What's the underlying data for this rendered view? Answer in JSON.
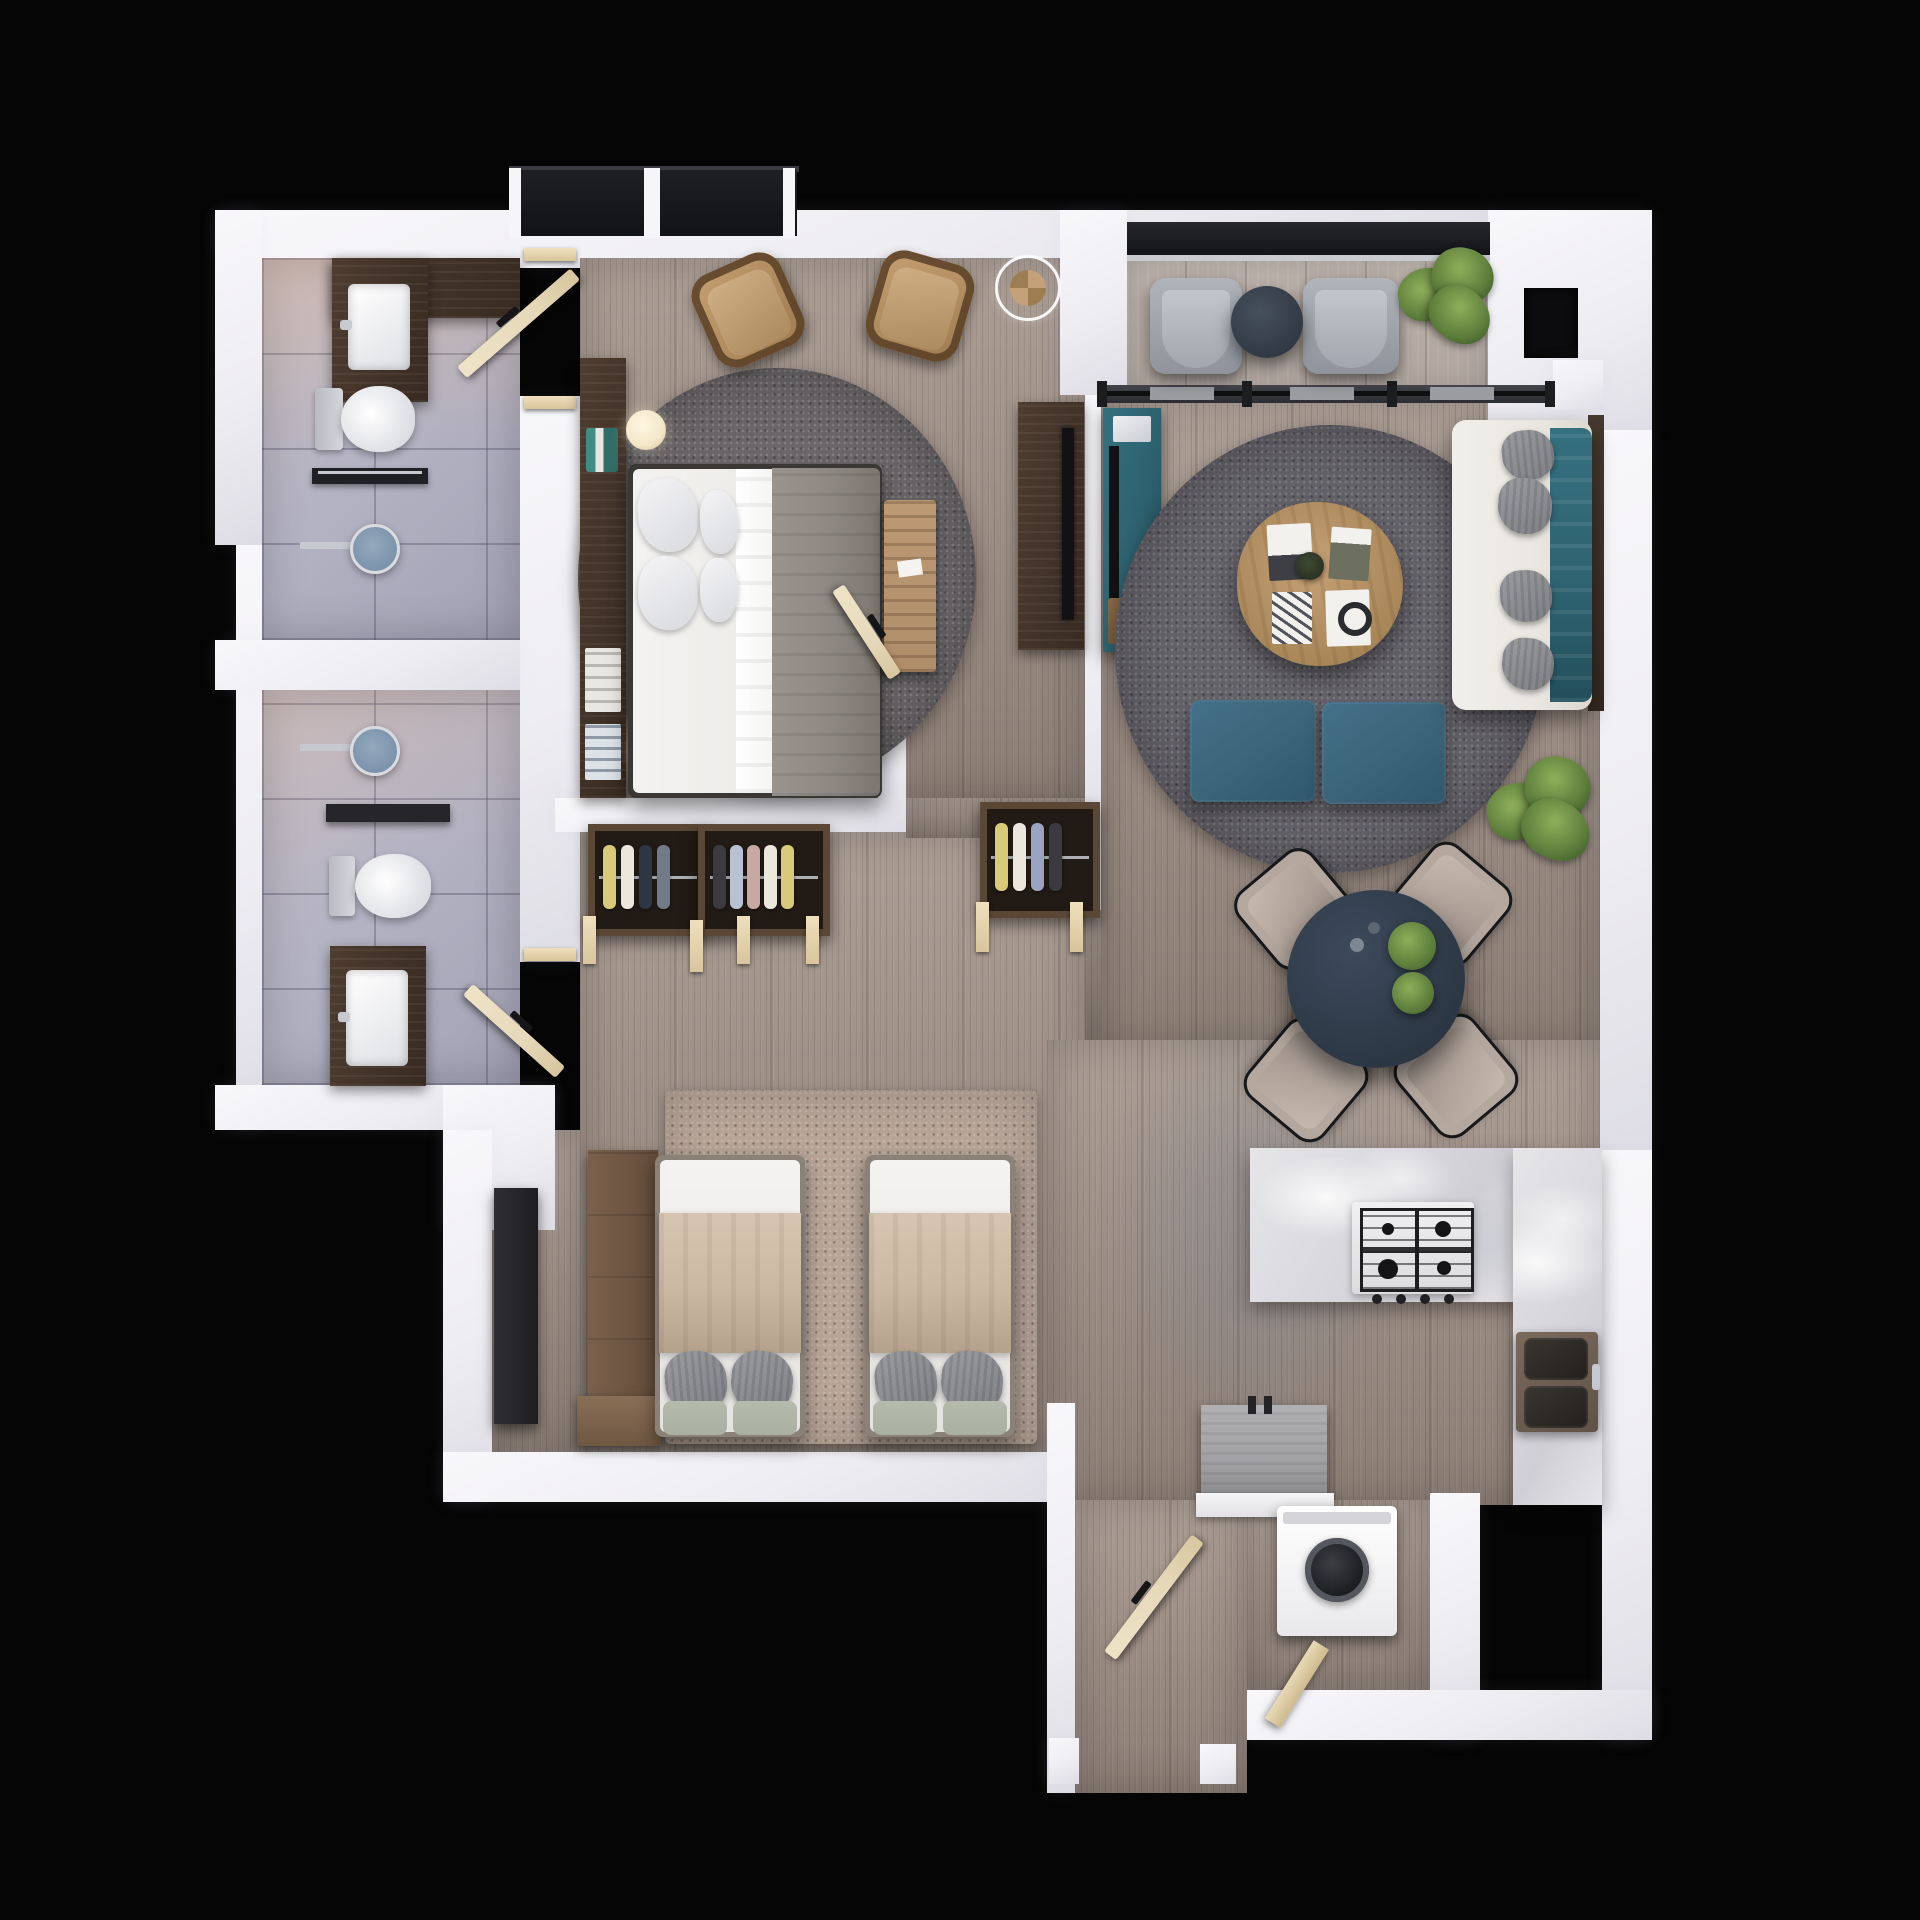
{
  "scene": {
    "label": "Top-down 3D render of a furnished two-bedroom apartment floor plan on a black background",
    "view": "top-down",
    "render_style": "photoreal 3D"
  },
  "colors": {
    "bg": "#050505",
    "wall_hi": "#f8f7fa",
    "wall": "#eeedf2",
    "wall_lo": "#dedde5",
    "tile_hi": "#c8bec4",
    "tile": "#b4b3c3",
    "tile_lo": "#a2a1b4",
    "grout": "rgba(84,82,104,0.38)",
    "wood_hi": "#ab9e95",
    "wood": "#9c8e85",
    "wood_lo": "#8b7e75",
    "grain": "rgba(56,43,34,0.16)",
    "deck_hi": "#bdb3ac",
    "deck": "#afa49d",
    "rug_dark": "#646269",
    "rug_master": "#6a6669",
    "rug_beige": "#b7a497",
    "walnut": "#4e3c30",
    "walnut_dark": "#382b21",
    "teal": "#2e6270",
    "teal_dark": "#234f5b",
    "slate": "#2f3a48",
    "ottoman": "#3b6478",
    "sofa": "#eae7e1",
    "pillow": "#8e8f93",
    "linen": "#f1f0ee",
    "blanket_gray": "#8d8781",
    "blanket_beige": "#cbb8a2",
    "sage": "#a9b0a1",
    "bench": "#b08d6a",
    "chairwood": "#b38f63",
    "door": "#e6d9ba",
    "glass": "#121316",
    "frame": "#3a3b40",
    "panel": "#9a9ca1",
    "marble": "#e6e6e9",
    "marble_lo": "#cfcfd5",
    "steel": "#c6c9cf",
    "shower": "#7b93ab",
    "plant_hi": "#8fae5b",
    "plant": "#5e7f3c",
    "plant_dark": "#42602c",
    "appliance": "#a2a2a5",
    "dark": "#1b1b1e",
    "white": "#f6f6f8",
    "closet_in": "#221b15",
    "seat": "#b3a79e",
    "lampc": "#f3e7c8"
  },
  "rooms": [
    {
      "id": "bathroom-1",
      "name": "Bathroom 1 (en-suite): vanity with sink, toilet, towel rail, walk-in shower, hinged door"
    },
    {
      "id": "bathroom-2",
      "name": "Bathroom 2: walk-in shower, wall shelf, toilet, vanity with sink, hinged door"
    },
    {
      "id": "master-bedroom",
      "name": "Master bedroom: picture window, two wooden armchairs, pendant lamp, round shag rug, headboard shelf with ball lamps, double bed, foot bench, TV console, hinged door"
    },
    {
      "id": "wardrobe-hall",
      "name": "Wardrobe hallway: three open closets with hanging clothes"
    },
    {
      "id": "living-room",
      "name": "Living room: sliding glass wall, back-to-back media consoles with TVs, round shag rug, live-edge coffee table with books, two teal ottomans, sofa with teal back cushions, potted plant"
    },
    {
      "id": "balcony",
      "name": "Balcony: glazing, two grey lounge chairs, round side table, potted plant"
    },
    {
      "id": "dining-area",
      "name": "Dining area: round dark table with greenery and four chairs"
    },
    {
      "id": "bedroom-2",
      "name": "Bedroom 2: speckled rug, two single beds, wardrobe, tall dark cabinet, chest of drawers"
    },
    {
      "id": "kitchen",
      "name": "Kitchen: island with gas cooktop, L-shaped stone counter, double sink, under-counter appliance"
    },
    {
      "id": "entry",
      "name": "Entry: entrance door, washing machine nook"
    }
  ]
}
